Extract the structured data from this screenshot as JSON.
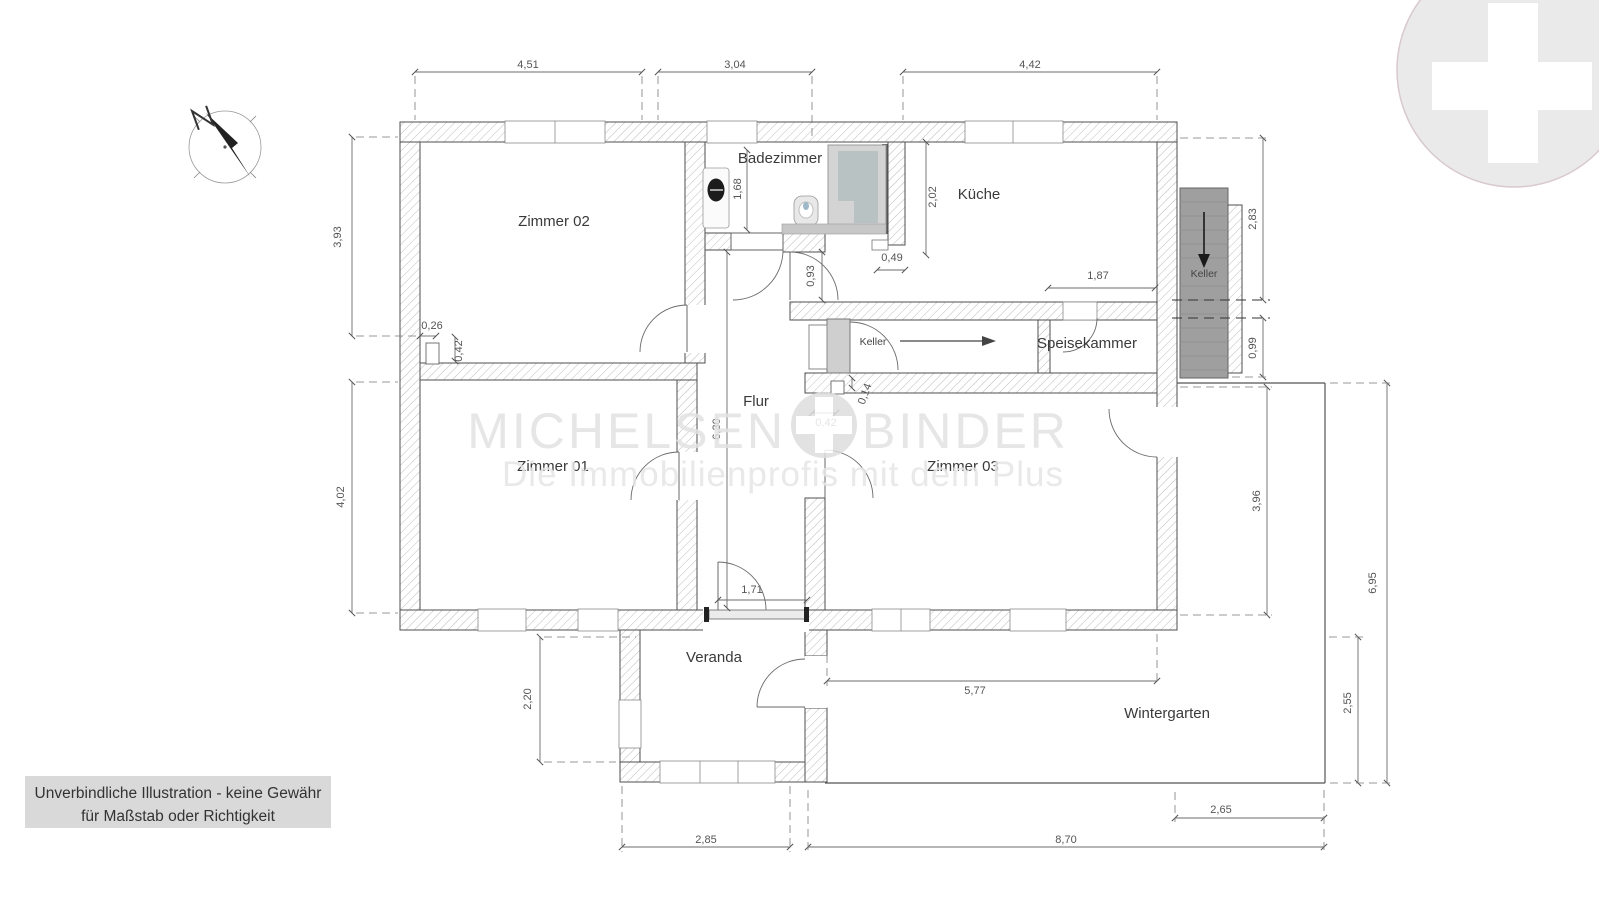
{
  "compass": {
    "north_label": "N"
  },
  "watermark": {
    "brand_left": "MICHELSEN",
    "brand_right": "BINDER",
    "tagline": "Die Immobilienprofis mit dem Plus"
  },
  "disclaimer": {
    "line1": "Unverbindliche Illustration - keine Gewähr",
    "line2": "für Maßstab oder Richtigkeit"
  },
  "rooms": {
    "zimmer01": {
      "label": "Zimmer 01"
    },
    "zimmer02": {
      "label": "Zimmer 02"
    },
    "zimmer03": {
      "label": "Zimmer 03"
    },
    "badezimmer": {
      "label": "Badezimmer"
    },
    "kueche": {
      "label": "Küche"
    },
    "flur": {
      "label": "Flur"
    },
    "speisekammer": {
      "label": "Speisekammer"
    },
    "veranda": {
      "label": "Veranda"
    },
    "wintergarten": {
      "label": "Wintergarten"
    },
    "keller_passage": {
      "label": "Keller"
    },
    "keller_stairs": {
      "label": "Keller"
    }
  },
  "dimensions": {
    "top_zimmer02": "4,51",
    "top_flur": "3,04",
    "top_kueche": "4,42",
    "left_zimmer02": "3,93",
    "left_zimmer01": "4,02",
    "left_veranda": "2,20",
    "bad_depth": "1,68",
    "kueche_left": "2,02",
    "bad_door": "0,93",
    "kueche_stub": "0,49",
    "speisekammer_width": "1,87",
    "right_keller_upper": "2,83",
    "right_keller_lower": "0,99",
    "chimney_width": "0,26",
    "chimney_depth": "0,42",
    "pillar_depth": "0,14",
    "pillar_width": "0,42",
    "flur_length": "6,30",
    "veranda_door": "1,71",
    "wintergarten_top": "5,77",
    "zimmer03_side": "3,96",
    "right_total": "6,95",
    "wintergarten_right": "2,55",
    "bottom_veranda": "2,85",
    "bottom_wintergarten": "8,70",
    "bottom_right": "2,65"
  },
  "colors": {
    "wall_outline": "#4f4f4f",
    "hatch": "#bcbcbc",
    "stairs_fill": "#9f9f9f",
    "door_block": "#cfcfcf",
    "watermark": "#e2e2e2",
    "logo_circle": "#eaeaea",
    "logo_ring": "#d8c9cd",
    "disclaimer_bg": "#d9d9d9",
    "dimension_text": "#555555",
    "room_text": "#3a3a3a"
  }
}
